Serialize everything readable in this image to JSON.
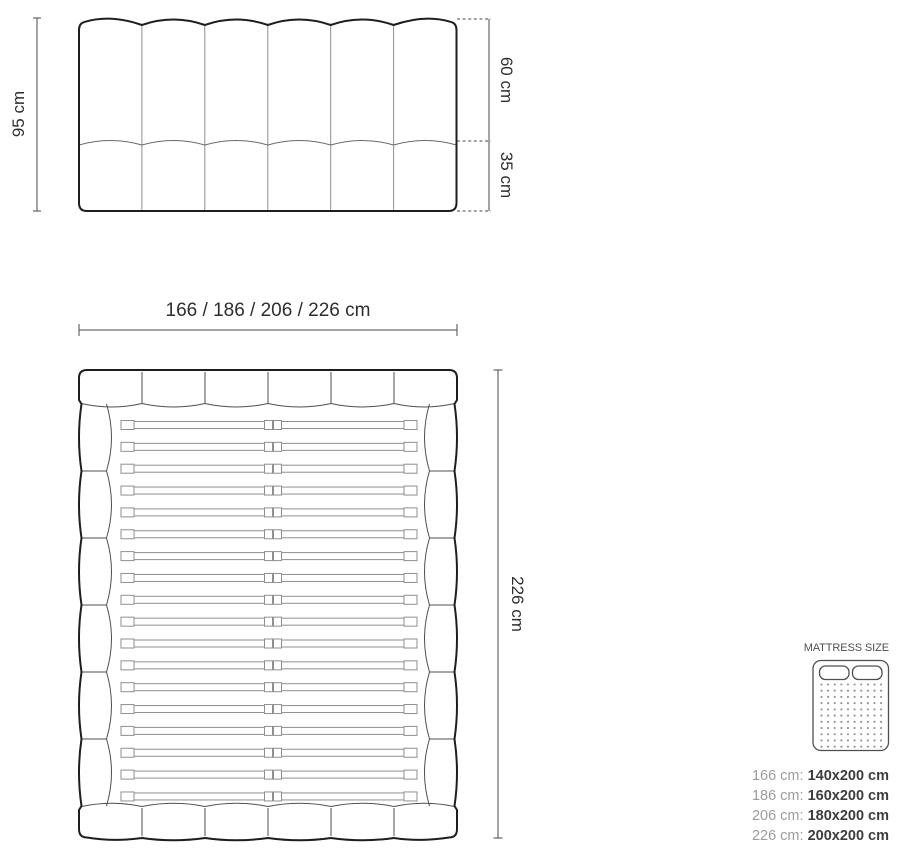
{
  "headboard_view": {
    "height_label": "95 cm",
    "upper_height_label": "60 cm",
    "lower_height_label": "35 cm"
  },
  "top_view": {
    "width_label": "166 / 186 / 206 / 226 cm",
    "length_label": "226 cm"
  },
  "mattress_legend": {
    "title": "MATTRESS SIZE",
    "rows": [
      {
        "frame_width": "166 cm:",
        "mattress_size": "140x200 cm"
      },
      {
        "frame_width": "186 cm:",
        "mattress_size": "160x200 cm"
      },
      {
        "frame_width": "206 cm:",
        "mattress_size": "180x200 cm"
      },
      {
        "frame_width": "226 cm:",
        "mattress_size": "200x200 cm"
      }
    ]
  },
  "colors": {
    "outline_dark": "#1e1e1e",
    "line_light": "#8f8f8f",
    "line_inner": "#4f4f4f",
    "line_mid": "#6a6a6a",
    "dimension_line": "#4a4a4a",
    "label_text": "#2e2e2e",
    "legend_title": "#4f4f4f",
    "legend_key_muted": "#9c9c9c",
    "legend_value_dark": "#3d3d3d",
    "background": "#ffffff"
  }
}
